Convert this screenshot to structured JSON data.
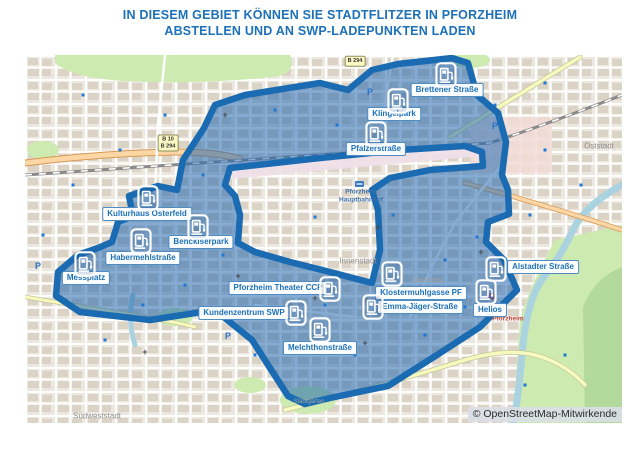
{
  "title": {
    "line1": "IN DIESEM GEBIET KÖNNEN SIE STADTFLITZER IN PFORZHEIM",
    "line2": "ABSTELLEN UND AN SWP-LADEPUNKTEN LADEN"
  },
  "colors": {
    "accent_blue": "#1d71b8",
    "zone_fill": "rgba(34,104,174,0.55)",
    "zone_stroke": "#1a6bb2",
    "park_green": "#cdebb0",
    "water_blue": "#aad3df",
    "road_orange": "#fcd6a4",
    "road_yellow": "#f7fabf"
  },
  "map": {
    "attribution": "© OpenStreetMap-Mitwirkende",
    "stations": [
      {
        "name": "Brettener Straße",
        "icon": {
          "x": 421,
          "y": 20
        },
        "label": {
          "x": 422,
          "y": 35
        }
      },
      {
        "name": "Klingelpark",
        "icon": {
          "x": 373,
          "y": 46
        },
        "label": {
          "x": 369,
          "y": 59
        }
      },
      {
        "name": "Pfalzerstraße",
        "icon": {
          "x": 351,
          "y": 79
        },
        "label": {
          "x": 351,
          "y": 94
        }
      },
      {
        "name": "Kulturhaus Osterfeld",
        "icon": {
          "x": 123,
          "y": 143
        },
        "label": {
          "x": 122,
          "y": 159
        }
      },
      {
        "name": "Benckiserpark",
        "icon": {
          "x": 173,
          "y": 172
        },
        "label": {
          "x": 176,
          "y": 187
        }
      },
      {
        "name": "Habermehlstraße",
        "icon": {
          "x": 116,
          "y": 186
        },
        "label": {
          "x": 118,
          "y": 203
        }
      },
      {
        "name": "Messplatz",
        "icon": {
          "x": 60,
          "y": 209
        },
        "label": {
          "x": 61,
          "y": 223
        }
      },
      {
        "name": "Pforzheim Theater CCP",
        "icon": {
          "x": 305,
          "y": 234
        },
        "label": {
          "x": 253,
          "y": 233
        }
      },
      {
        "name": "Kundenzentrum SWP",
        "icon": {
          "x": 271,
          "y": 258
        },
        "label": {
          "x": 219,
          "y": 258
        }
      },
      {
        "name": "Melchthonstraße",
        "icon": {
          "x": 295,
          "y": 275
        },
        "label": {
          "x": 295,
          "y": 293
        }
      },
      {
        "name": "Klostermuhlgasse PF",
        "icon": {
          "x": 367,
          "y": 219
        },
        "label": {
          "x": 396,
          "y": 238
        }
      },
      {
        "name": "Emma-Jäger-Straße",
        "icon": {
          "x": 348,
          "y": 252
        },
        "label": {
          "x": 395,
          "y": 252
        }
      },
      {
        "name": "Helios",
        "icon": {
          "x": 461,
          "y": 237
        },
        "label": {
          "x": 465,
          "y": 255
        }
      },
      {
        "name": "Alstadter Straße",
        "icon": {
          "x": 471,
          "y": 214
        },
        "label": {
          "x": 518,
          "y": 212
        }
      }
    ],
    "place_labels": [
      {
        "type": "station",
        "text": "Pforzheim",
        "x": 336,
        "y": 137
      },
      {
        "type": "station",
        "text": "Hauptbahnhof",
        "x": 336,
        "y": 145
      },
      {
        "type": "district",
        "text": "Innenstadt",
        "x": 333,
        "y": 206
      },
      {
        "type": "district",
        "text": "Oststadt",
        "x": 574,
        "y": 91
      },
      {
        "type": "district",
        "text": "Südweststadt",
        "x": 72,
        "y": 361
      },
      {
        "type": "minor",
        "text": "Auerbrücke",
        "x": 402,
        "y": 226
      },
      {
        "type": "minor",
        "text": "Stadtgarten",
        "x": 284,
        "y": 347
      },
      {
        "type": "hospital",
        "text": "Pforzheim",
        "x": 483,
        "y": 264
      },
      {
        "type": "parking",
        "text": "P",
        "x": 13,
        "y": 211
      },
      {
        "type": "parking",
        "text": "P",
        "x": 470,
        "y": 71
      },
      {
        "type": "parking",
        "text": "P",
        "x": 206,
        "y": 232
      },
      {
        "type": "parking",
        "text": "P",
        "x": 203,
        "y": 281
      },
      {
        "type": "parking",
        "text": "P",
        "x": 345,
        "y": 37
      },
      {
        "type": "church",
        "text": "+",
        "x": 200,
        "y": 60
      },
      {
        "type": "church",
        "text": "+",
        "x": 96,
        "y": 158
      },
      {
        "type": "church",
        "text": "+",
        "x": 213,
        "y": 221
      },
      {
        "type": "church",
        "text": "+",
        "x": 290,
        "y": 243
      },
      {
        "type": "church",
        "text": "+",
        "x": 353,
        "y": 172
      },
      {
        "type": "church",
        "text": "+",
        "x": 456,
        "y": 197
      },
      {
        "type": "church",
        "text": "+",
        "x": 120,
        "y": 297
      },
      {
        "type": "church",
        "text": "+",
        "x": 340,
        "y": 288
      }
    ],
    "road_shields": [
      {
        "text": "B 10|B 294",
        "x": 143,
        "y": 88
      },
      {
        "text": "B 294",
        "x": 330,
        "y": 6
      }
    ],
    "dots": [
      [
        48,
        130
      ],
      [
        95,
        95
      ],
      [
        140,
        60
      ],
      [
        250,
        55
      ],
      [
        312,
        70
      ],
      [
        390,
        55
      ],
      [
        432,
        40
      ],
      [
        470,
        50
      ],
      [
        520,
        95
      ],
      [
        556,
        130
      ],
      [
        505,
        160
      ],
      [
        452,
        182
      ],
      [
        420,
        205
      ],
      [
        355,
        243
      ],
      [
        300,
        250
      ],
      [
        255,
        230
      ],
      [
        198,
        200
      ],
      [
        160,
        230
      ],
      [
        118,
        250
      ],
      [
        80,
        285
      ],
      [
        230,
        300
      ],
      [
        330,
        300
      ],
      [
        400,
        280
      ],
      [
        440,
        252
      ],
      [
        520,
        28
      ],
      [
        58,
        40
      ],
      [
        18,
        180
      ],
      [
        290,
        162
      ],
      [
        368,
        160
      ],
      [
        178,
        120
      ],
      [
        540,
        300
      ],
      [
        500,
        330
      ]
    ]
  }
}
